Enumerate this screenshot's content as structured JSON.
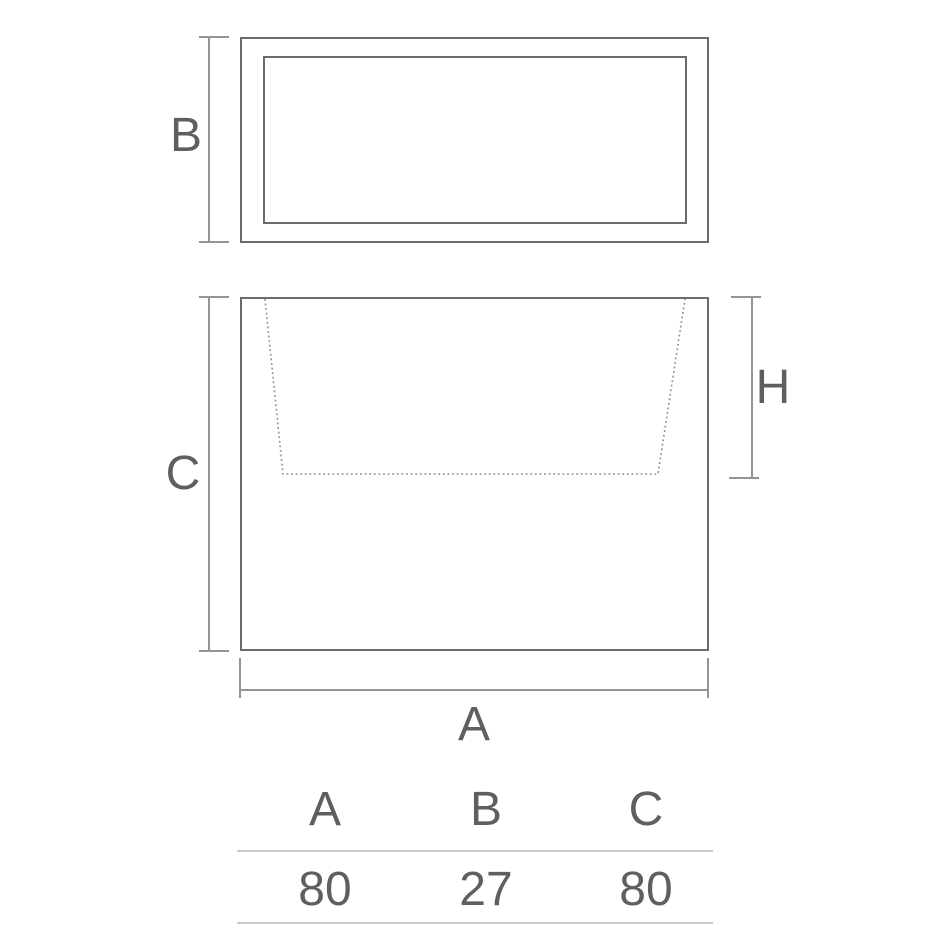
{
  "drawing": {
    "labels": {
      "a": "A",
      "b": "B",
      "c": "C",
      "h": "H"
    }
  },
  "table": {
    "headers": [
      "A",
      "B",
      "C"
    ],
    "values": [
      "80",
      "27",
      "80"
    ]
  },
  "colors": {
    "outline": "#6b6b6b",
    "dimension_line": "#949494",
    "dashed_cavity_line": "#8f8f8f",
    "label_text": "#5f5f5f",
    "table_rule": "#cccccc"
  }
}
